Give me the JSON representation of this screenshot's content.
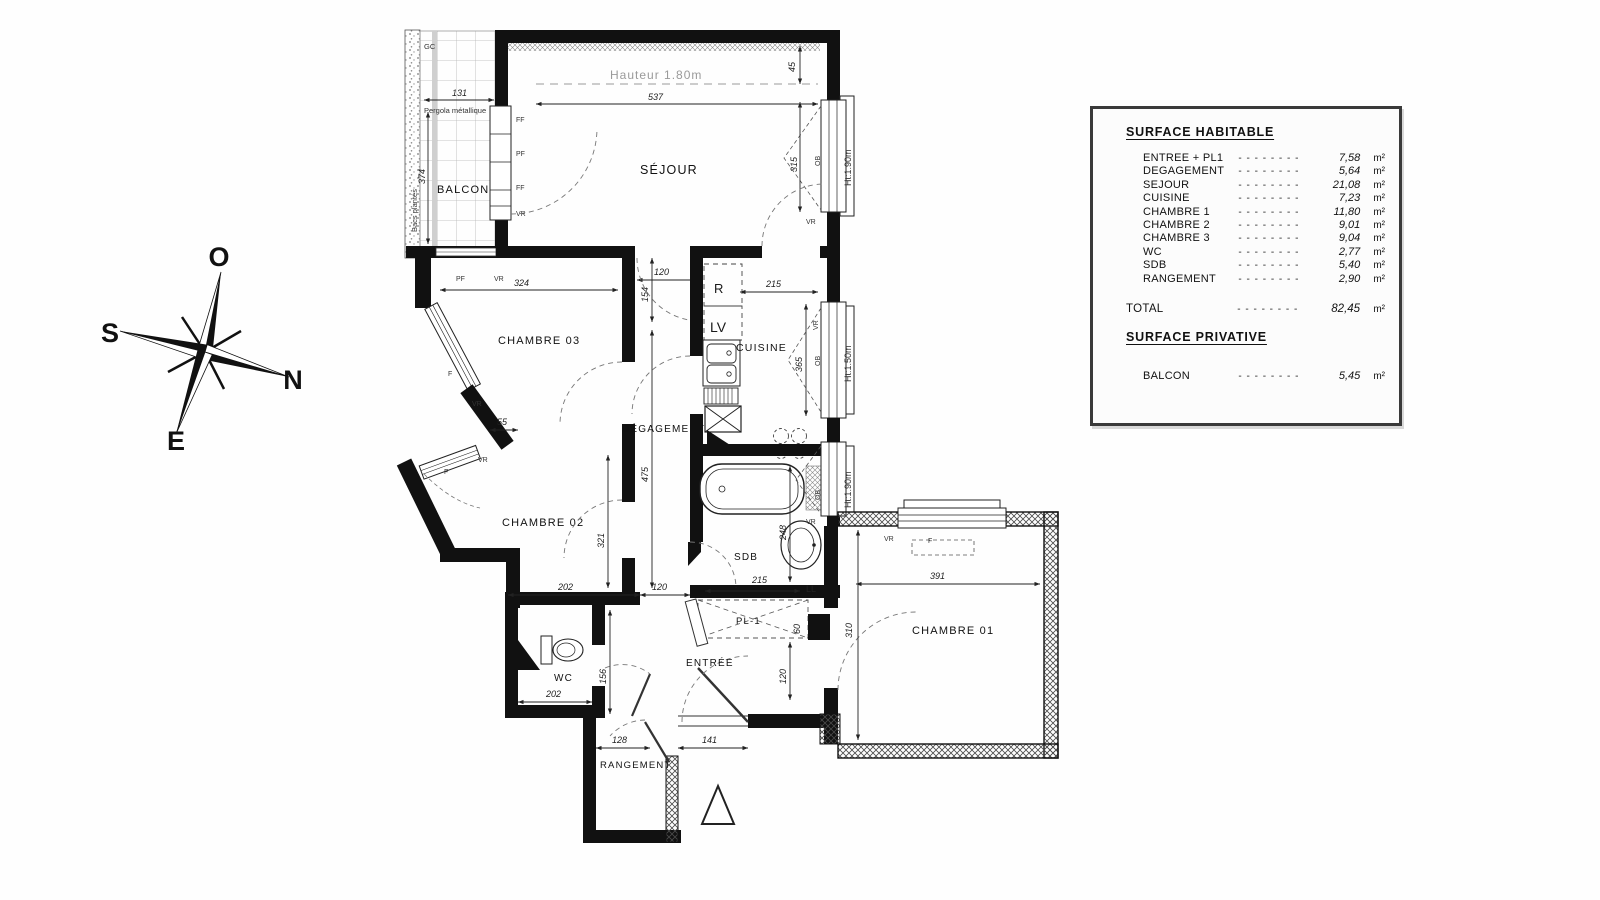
{
  "legend": {
    "surface_habitable_title": "SURFACE HABITABLE",
    "surface_privative_title": "SURFACE PRIVATIVE",
    "dashes": "- - - - - - - -",
    "unit": "m²",
    "rows": [
      {
        "label": "ENTREE + PL1",
        "value": "7,58"
      },
      {
        "label": "DEGAGEMENT",
        "value": "5,64"
      },
      {
        "label": "SEJOUR",
        "value": "21,08"
      },
      {
        "label": "CUISINE",
        "value": "7,23"
      },
      {
        "label": "CHAMBRE 1",
        "value": "11,80"
      },
      {
        "label": "CHAMBRE 2",
        "value": "9,01"
      },
      {
        "label": "CHAMBRE 3",
        "value": "9,04"
      },
      {
        "label": "WC",
        "value": "2,77"
      },
      {
        "label": "SDB",
        "value": "5,40"
      },
      {
        "label": "RANGEMENT",
        "value": "2,90"
      }
    ],
    "total": {
      "label": "TOTAL",
      "value": "82,45"
    },
    "balcon_row": {
      "label": "BALCON",
      "value": "5,45"
    }
  },
  "compass": {
    "o": "O",
    "s": "S",
    "n": "N",
    "e": "E"
  },
  "plan": {
    "rooms": {
      "balcon": "BALCON",
      "sejour": "SÉJOUR",
      "ch03": "CHAMBRE 03",
      "cuisine": "CUISINE",
      "degagement": "DÉGAGEMENT",
      "ch02": "CHAMBRE 02",
      "sdb": "SDB",
      "wc": "WC",
      "entree": "ENTRÉE",
      "pl1": "PL-1",
      "ch01": "CHAMBRE 01",
      "rangement": "RANGEMENT"
    },
    "annotations": {
      "hauteur": "Hauteur 1.80m",
      "pergola": "Pergola métallique",
      "bacs": "Bacs plantés",
      "gc": "GC",
      "fridge": "R",
      "dishwasher": "LV",
      "washer": "LL"
    },
    "windows": {
      "ff": "FF",
      "pf": "PF",
      "vr": "VR",
      "ob": "OB",
      "f": "F",
      "ht190": "Ht:1.90m",
      "ht150": "Ht:1.50m"
    },
    "dims": {
      "balcon_w": "131",
      "balcon_h": "374",
      "sejour_w": "537",
      "sejour_top": "45",
      "sejour_win": "315",
      "ch03_w": "324",
      "deg_w": "120",
      "deg_top": "154",
      "cuisine_w": "215",
      "cuisine_h": "365",
      "ch03_small": "55",
      "deg_h": "475",
      "ch02_h": "321",
      "ch02_w": "202",
      "deg_bottom": "120",
      "sdb_w": "215",
      "sdb_h": "248",
      "wc_w": "202",
      "wc_h": "156",
      "rangement_w": "128",
      "entree_door": "141",
      "pl1_d": "60",
      "entree_h": "120",
      "ch01_h": "310",
      "ch01_w": "391"
    }
  }
}
